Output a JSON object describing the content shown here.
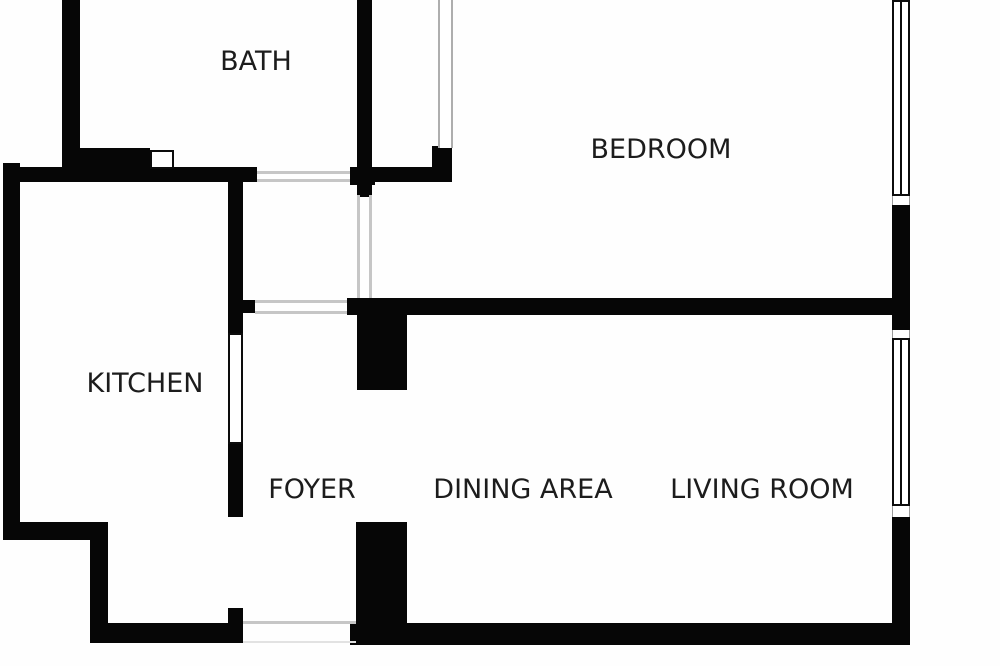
{
  "floorplan": {
    "background_color": "#fefefe",
    "wall_color": "#060606",
    "opening_color": "#c6c6c6",
    "rooms": [
      {
        "label": "BATH",
        "cx": 256,
        "cy": 62
      },
      {
        "label": "BEDROOM",
        "cx": 661,
        "cy": 150
      },
      {
        "label": "KITCHEN",
        "cx": 145,
        "cy": 384
      },
      {
        "label": "FOYER",
        "cx": 312,
        "cy": 490
      },
      {
        "label": "DINING AREA",
        "cx": 523,
        "cy": 490
      },
      {
        "label": "LIVING ROOM",
        "cx": 762,
        "cy": 490
      }
    ],
    "walls": [
      {
        "name": "bath-left-wall",
        "rect": [
          62,
          0,
          18,
          182
        ]
      },
      {
        "name": "kitchen-left-wall",
        "rect": [
          3,
          163,
          17,
          377
        ]
      },
      {
        "name": "kitchen-top-wall",
        "rect": [
          3,
          167,
          254,
          15
        ]
      },
      {
        "name": "bath-bottom-wall",
        "rect": [
          80,
          148,
          70,
          34
        ]
      },
      {
        "name": "bath-right-wall",
        "rect": [
          357,
          0,
          15,
          197
        ]
      },
      {
        "name": "bath-right-wall-foot",
        "rect": [
          350,
          167,
          25,
          18
        ]
      },
      {
        "name": "hall-top-wall",
        "rect": [
          372,
          167,
          80,
          15
        ]
      },
      {
        "name": "hall-corner-wall",
        "rect": [
          432,
          146,
          20,
          22
        ]
      },
      {
        "name": "kitchen-foyer-wall-upper",
        "rect": [
          228,
          180,
          15,
          153
        ]
      },
      {
        "name": "kitchen-foyer-wall-mid",
        "rect": [
          228,
          443,
          15,
          74
        ]
      },
      {
        "name": "kitchen-foyer-wall-lower",
        "rect": [
          228,
          608,
          15,
          35
        ]
      },
      {
        "name": "foyer-jamb-stub",
        "rect": [
          243,
          300,
          12,
          13
        ]
      },
      {
        "name": "bedroom-bottom-wall",
        "rect": [
          347,
          298,
          545,
          17
        ]
      },
      {
        "name": "foyer-column-upper",
        "rect": [
          357,
          298,
          50,
          92
        ]
      },
      {
        "name": "foyer-column-lower",
        "rect": [
          356,
          522,
          51,
          121
        ]
      },
      {
        "name": "kitchen-step-wall-h",
        "rect": [
          3,
          522,
          105,
          18
        ]
      },
      {
        "name": "kitchen-step-wall-v",
        "rect": [
          90,
          522,
          18,
          121
        ]
      },
      {
        "name": "kitchen-bottom-wall",
        "rect": [
          90,
          623,
          153,
          20
        ]
      },
      {
        "name": "bottom-wall",
        "rect": [
          350,
          623,
          560,
          22
        ]
      },
      {
        "name": "right-wall-upper",
        "rect": [
          892,
          205,
          18,
          125
        ]
      },
      {
        "name": "right-wall-lower",
        "rect": [
          892,
          517,
          18,
          128
        ]
      }
    ],
    "openings": [
      {
        "name": "bath-door-opening-top",
        "rect": [
          257,
          171,
          93,
          3
        ],
        "faint": false
      },
      {
        "name": "bath-door-opening-bottom",
        "rect": [
          257,
          179,
          93,
          3
        ],
        "faint": false
      },
      {
        "name": "hall-door-opening-top",
        "rect": [
          255,
          300,
          92,
          3
        ],
        "faint": false
      },
      {
        "name": "hall-door-opening-bottom",
        "rect": [
          255,
          311,
          92,
          3
        ],
        "faint": false
      },
      {
        "name": "hall-door-opening-left",
        "rect": [
          357,
          195,
          3,
          103
        ],
        "faint": false
      },
      {
        "name": "hall-door-opening-right",
        "rect": [
          369,
          195,
          3,
          103
        ],
        "faint": false
      },
      {
        "name": "entry-door-opening-top",
        "rect": [
          243,
          621,
          113,
          3
        ],
        "faint": false
      },
      {
        "name": "entry-door-opening-bottom",
        "rect": [
          243,
          641,
          113,
          2
        ],
        "faint": true
      }
    ],
    "windows": [
      {
        "name": "bath-passthrough-window",
        "rect": [
          150,
          150,
          24,
          19
        ],
        "mullion": false
      },
      {
        "name": "kitchen-serving-window",
        "rect": [
          228,
          333,
          15,
          111
        ],
        "mullion": false
      },
      {
        "name": "bedroom-window",
        "rect": [
          892,
          0,
          18,
          196
        ],
        "mullion": true
      },
      {
        "name": "living-room-window",
        "rect": [
          892,
          338,
          18,
          168
        ],
        "mullion": true
      }
    ],
    "sills": [
      {
        "name": "bedroom-window-sill",
        "rect": [
          892,
          196,
          18,
          9
        ]
      },
      {
        "name": "living-room-window-sill-top",
        "rect": [
          892,
          330,
          18,
          8
        ]
      },
      {
        "name": "living-room-window-sill-bottom",
        "rect": [
          892,
          506,
          18,
          11
        ]
      }
    ],
    "doors": [
      {
        "name": "bedroom-door-leaf",
        "rect": [
          438,
          0,
          15,
          148
        ]
      }
    ]
  }
}
